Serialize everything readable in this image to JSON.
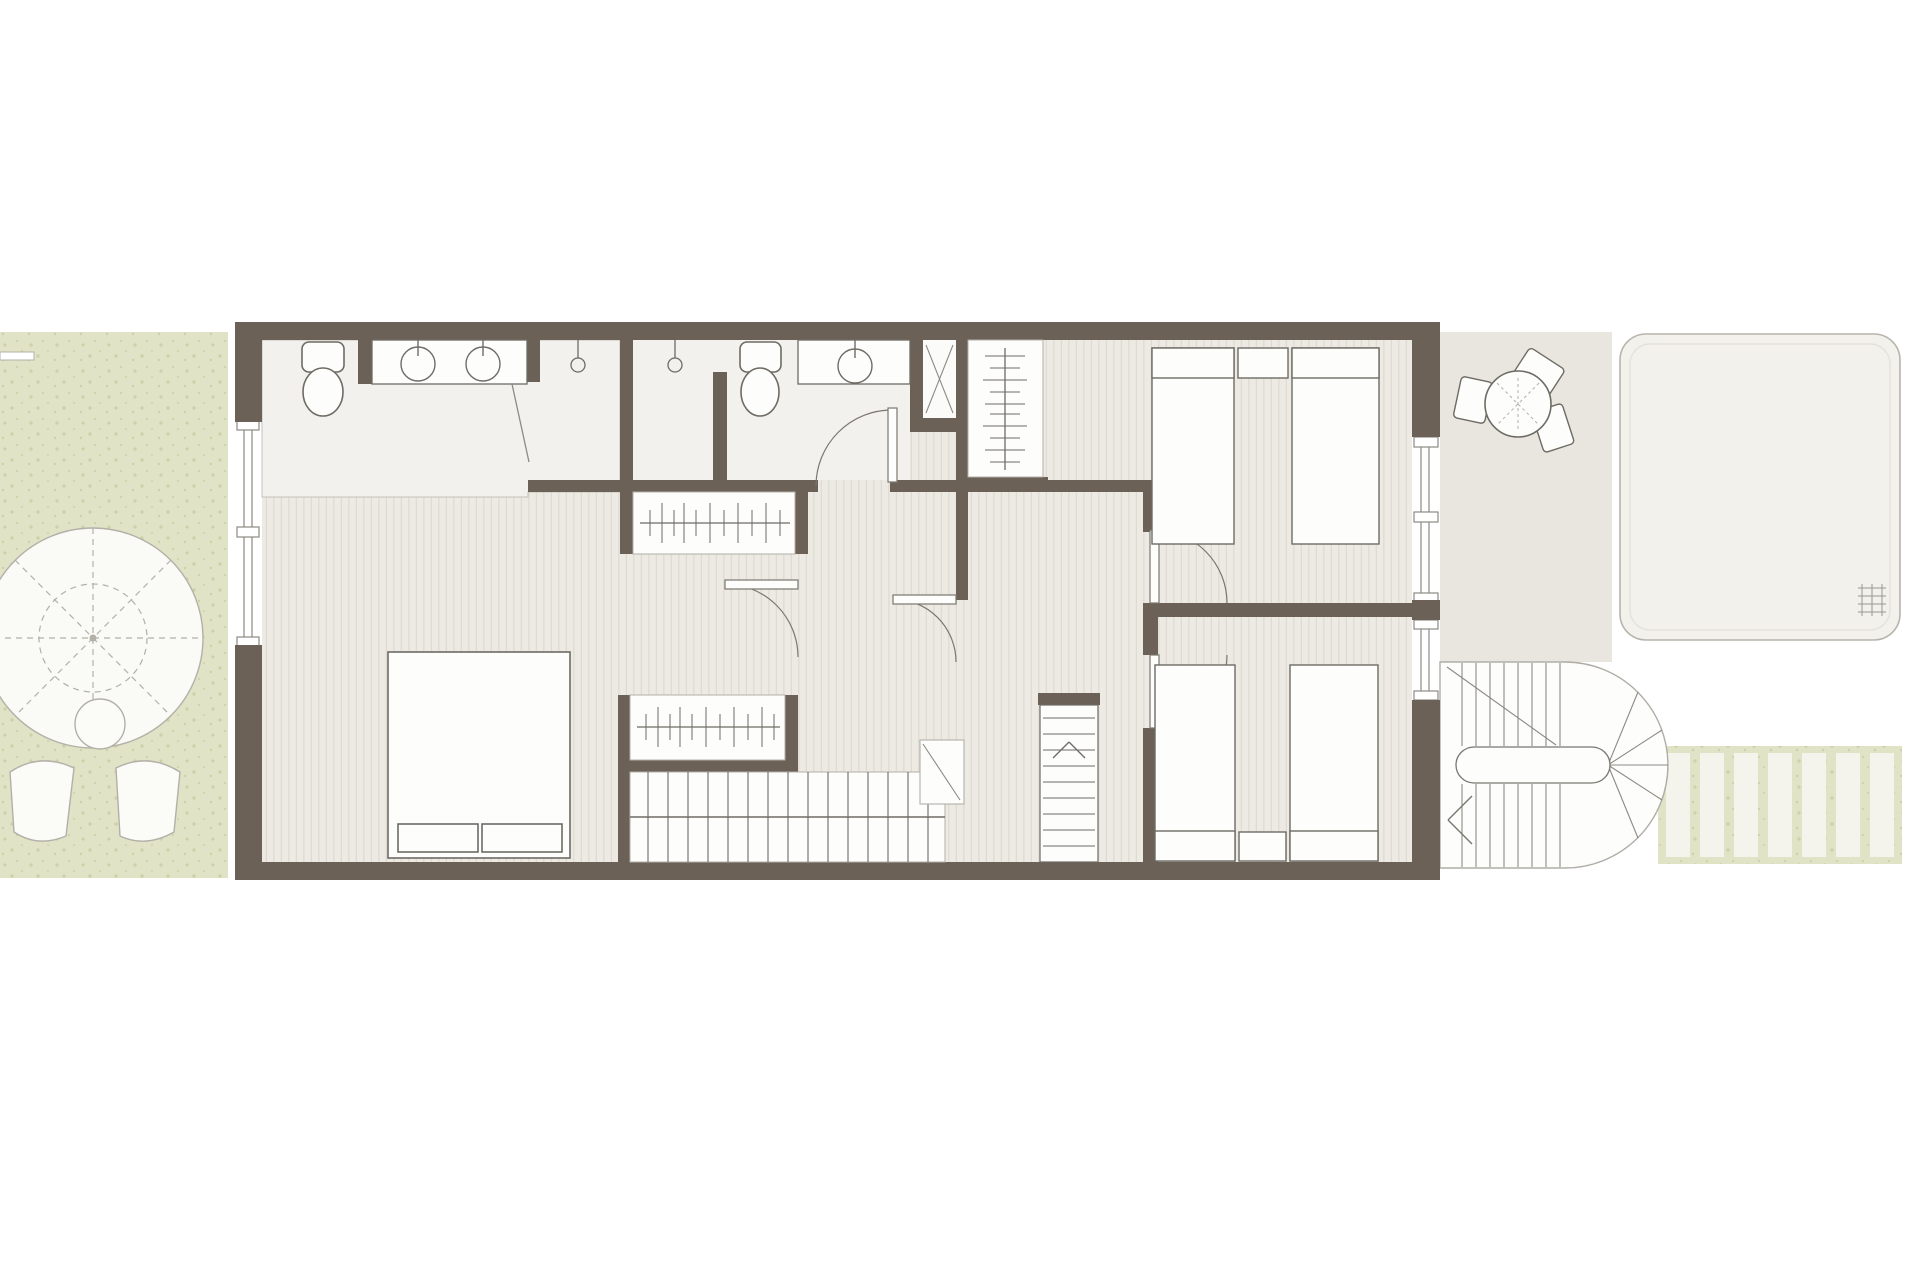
{
  "document": {
    "type": "architectural-floor-plan",
    "floor": "upper-floor",
    "visible_text": []
  },
  "palette": {
    "wall": "#6b6156",
    "floor": "#edeae4",
    "floorLine": "#dfdbd3",
    "bath": "#f2f1ed",
    "white": "#fdfdfb",
    "stroke": "#6e6b64",
    "thin": "#8d8a83",
    "lt": "#b3b0a8",
    "garden": "#e0e3c6",
    "gardenDot": "#cdd1a8",
    "terrace": "#e8e6df",
    "pool": "#f2f1ec"
  },
  "inventory": {
    "garden": [
      "parasol-icon",
      "side-table-icon",
      "lounger-icon",
      "lounger-icon"
    ],
    "bathroom_1": [
      "toilet-icon",
      "double-basin-vanity-icon",
      "shower-head-icon",
      "shower-head-icon",
      "glass-door-icon"
    ],
    "bathroom_2": [
      "toilet-icon",
      "basin-vanity-icon",
      "shower-cabin-icon"
    ],
    "closets": [
      "wardrobe-rail-icon",
      "wardrobe-rail-icon",
      "wardrobe-rail-icon"
    ],
    "bedroom_master": [
      "double-bed-icon"
    ],
    "bedroom_2": [
      "single-bed-icon",
      "single-bed-icon",
      "nightstand-icon"
    ],
    "bedroom_3": [
      "single-bed-icon",
      "single-bed-icon",
      "nightstand-icon"
    ],
    "circulation": [
      "straight-staircase-icon",
      "ladder-stair-icon",
      "return-spiral-staircase-icon"
    ],
    "terrace": [
      "round-table-icon",
      "chair-icon",
      "chair-icon",
      "chair-icon",
      "pool-icon",
      "deck-planks-icon"
    ],
    "openings": [
      "window",
      "window",
      "window",
      "door-swing",
      "door-swing",
      "door-swing",
      "door-swing",
      "door-swing"
    ]
  },
  "counts": {
    "bedrooms": 3,
    "bathrooms": 2,
    "beds_single": 4,
    "beds_double": 1,
    "door_swings": 5,
    "windows": 3,
    "staircases": 3
  }
}
